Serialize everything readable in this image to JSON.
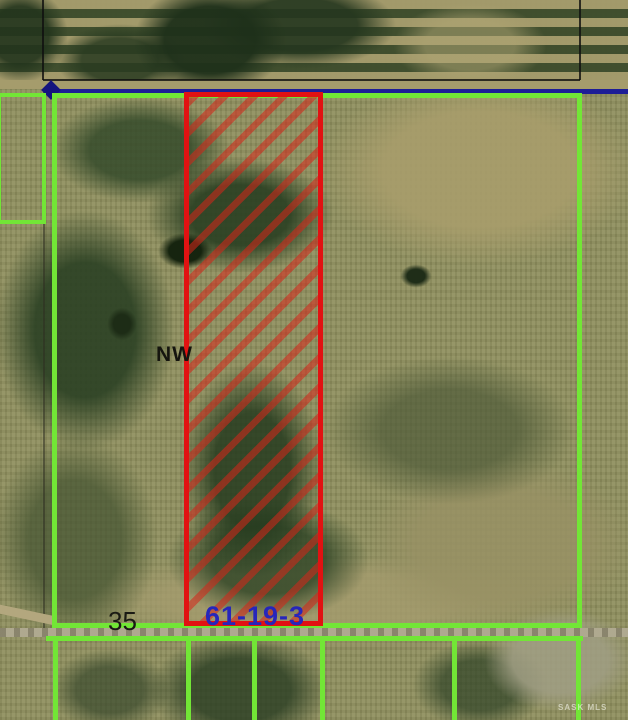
{
  "map": {
    "description": "Aerial cadastral parcel map with highlighted quarter section",
    "labels": {
      "quarter": "NW",
      "section": "35",
      "township": "61-19-3",
      "watermark": "SASK MLS"
    },
    "colors": {
      "parcel_boundary": "#72e636",
      "highlight_boundary": "#e11212",
      "blue_road_line": "#1d1d96",
      "survey_line": "#0f0f0f",
      "section_text": "#1a1a14",
      "township_text": "#2626bb"
    }
  }
}
